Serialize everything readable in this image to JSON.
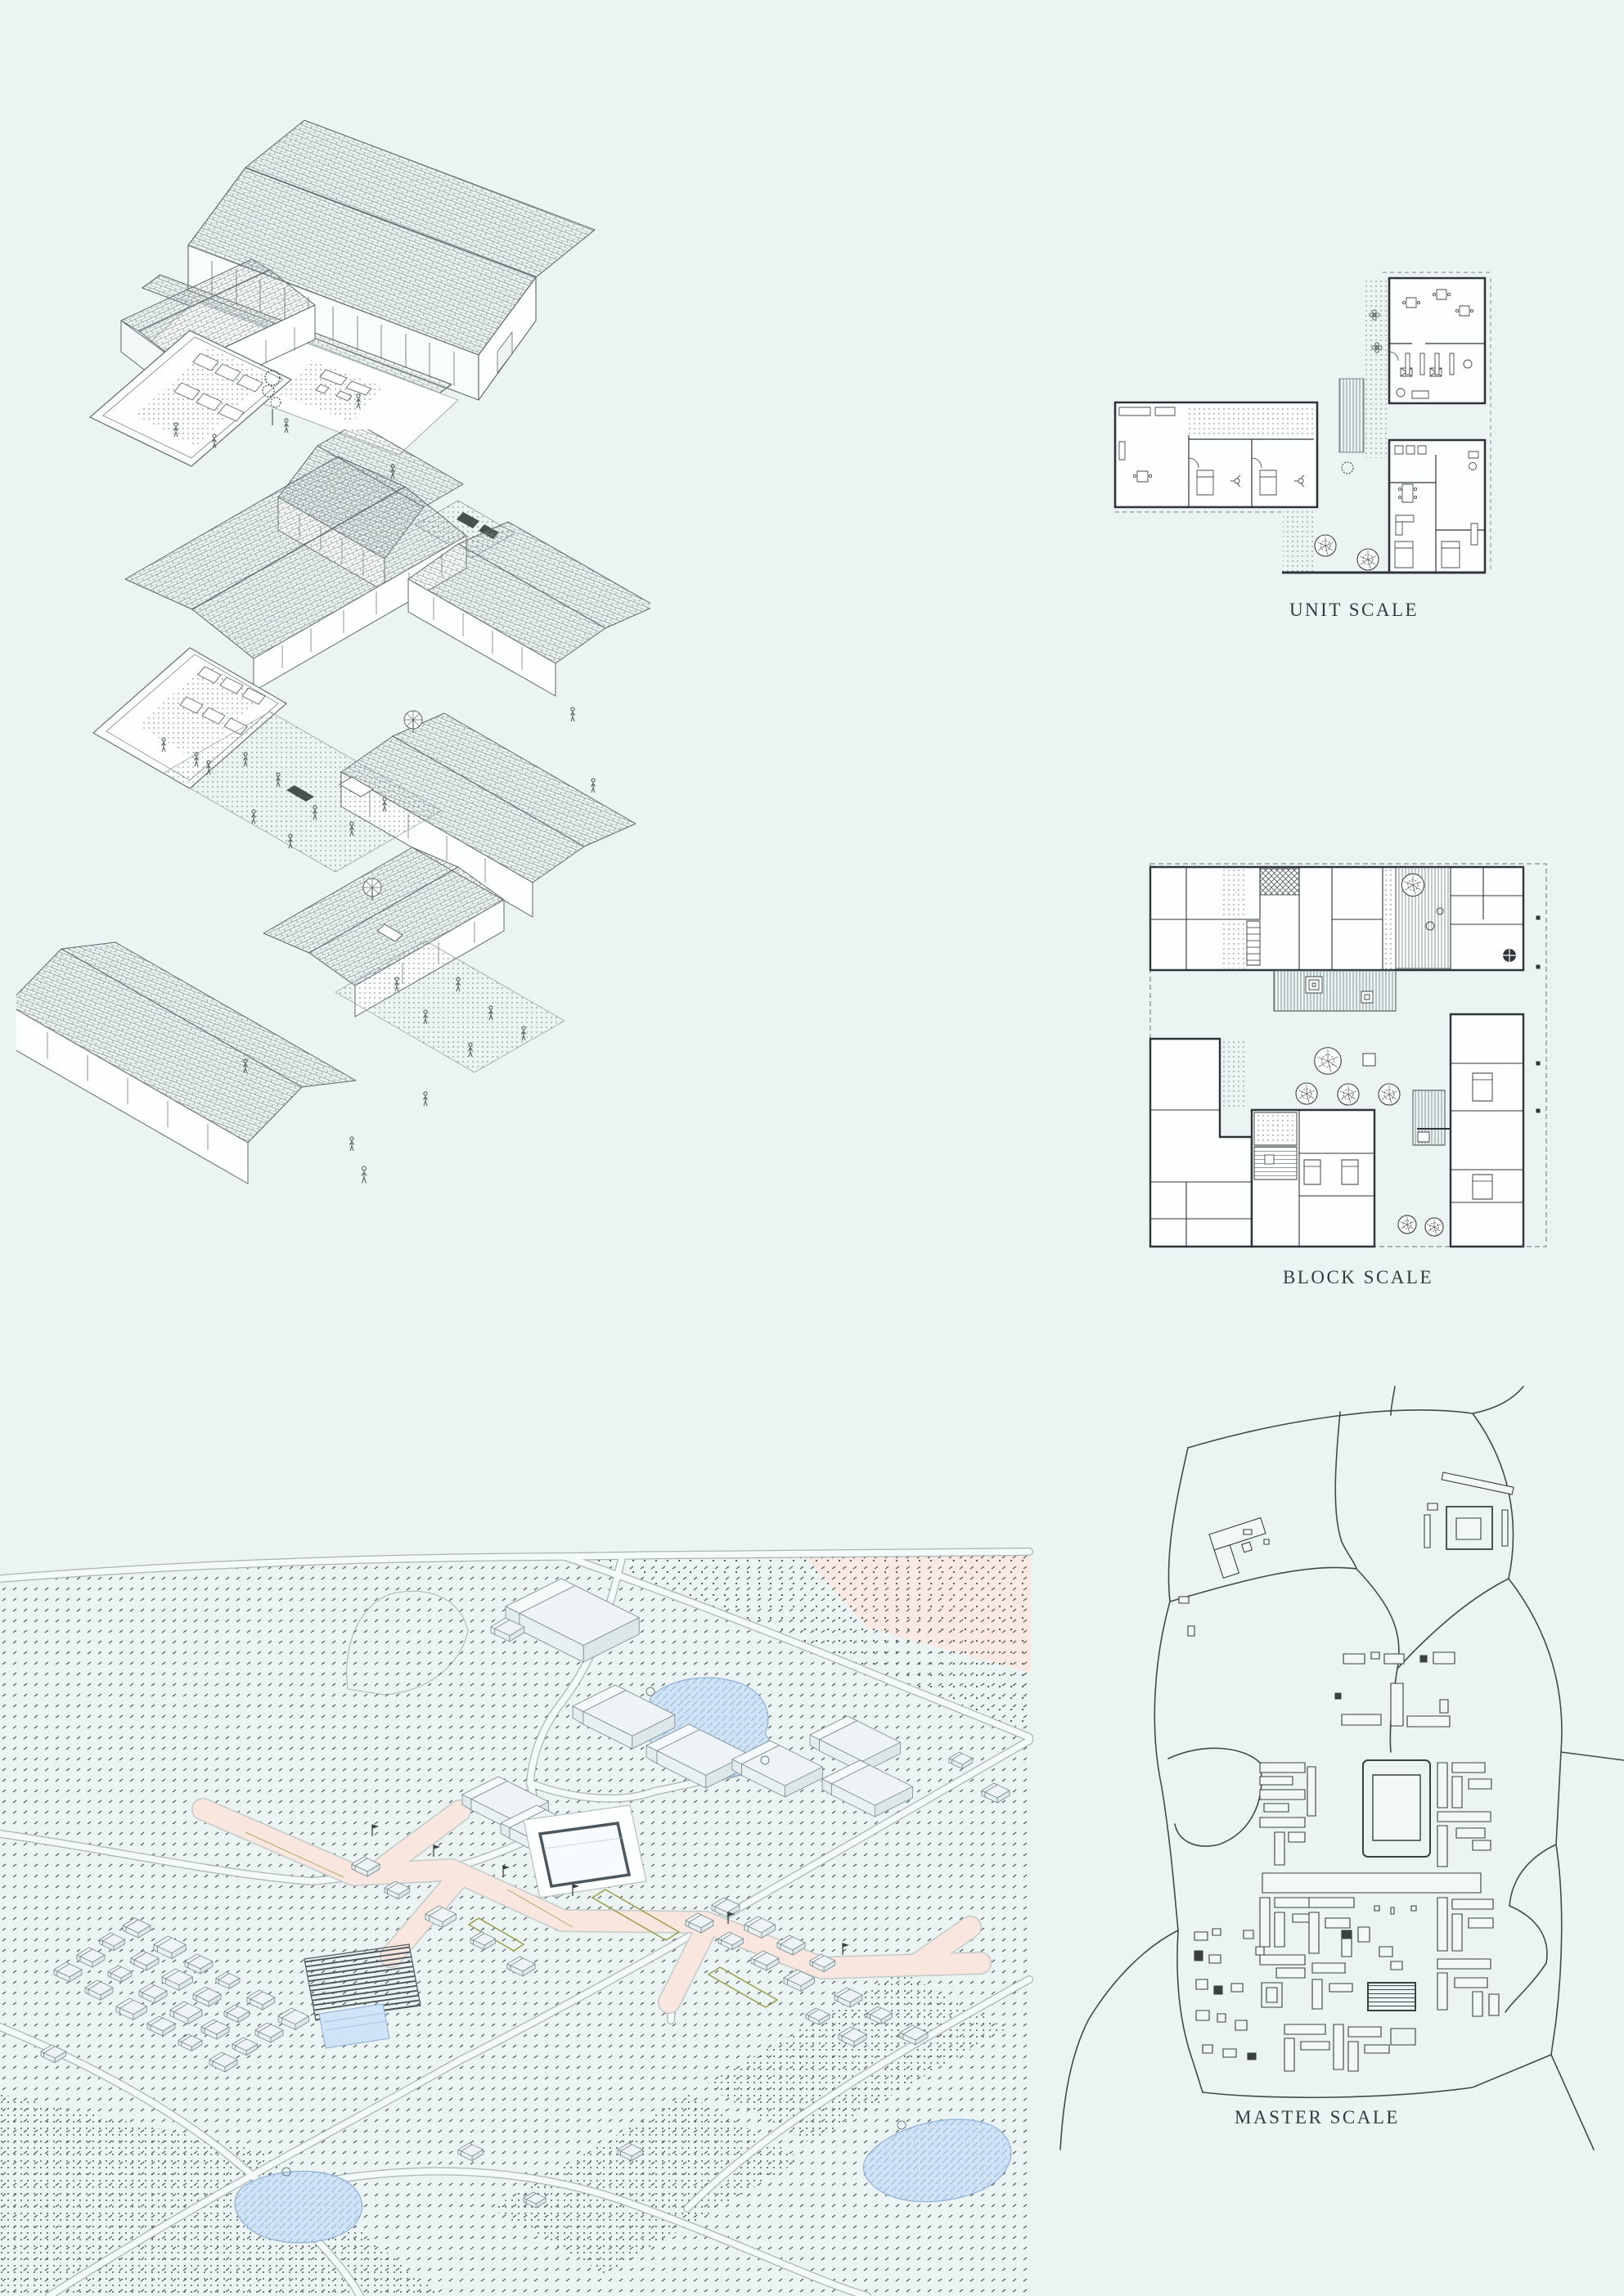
{
  "captions": {
    "unit": "UNIT SCALE",
    "block": "BLOCK SCALE",
    "master": "MASTER SCALE"
  },
  "colors": {
    "background": "#ebf3f3",
    "axon_linework": "#5d6868",
    "plan_linework": "#2e3538",
    "roof_hatch": "#8a9494",
    "field_dot": "#4b5858",
    "pink_street": "#f9e6df",
    "pink_field": "#fae9e3",
    "water_fill": "#cfe3f5",
    "water_line": "#8fb0d8",
    "olive_accent": "#9aa04a",
    "road_edge": "#aab4b4",
    "pool_rim": "#4b565e"
  }
}
